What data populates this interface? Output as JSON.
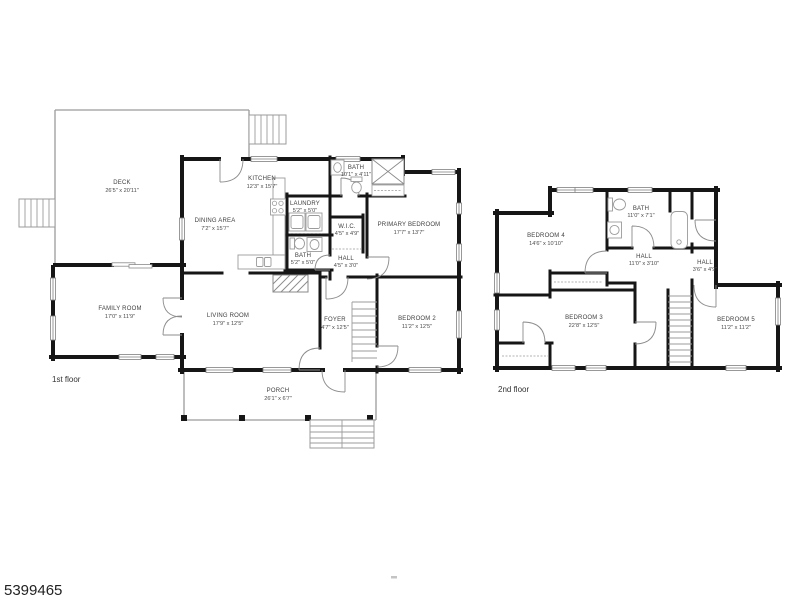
{
  "listing_id": "5399465",
  "floor1": {
    "label": "1st floor",
    "rooms": {
      "deck": {
        "name": "DECK",
        "dims": "26'5\" x 20'11\""
      },
      "kitchen": {
        "name": "KITCHEN",
        "dims": "12'3\" x 15'7\""
      },
      "bath_top": {
        "name": "BATH",
        "dims": "10'1\" x 4'11\""
      },
      "dining": {
        "name": "DINING AREA",
        "dims": "7'2\" x 15'7\""
      },
      "laundry": {
        "name": "LAUNDRY",
        "dims": "5'2\" x 5'0\""
      },
      "wic": {
        "name": "W.I.C.",
        "dims": "4'5\" x 4'9\""
      },
      "primary_bedroom": {
        "name": "PRIMARY BEDROOM",
        "dims": "17'7\" x 13'7\""
      },
      "bath_lower": {
        "name": "BATH",
        "dims": "5'2\" x 5'0\""
      },
      "hall": {
        "name": "HALL",
        "dims": "4'5\" x 3'0\""
      },
      "family_room": {
        "name": "FAMILY ROOM",
        "dims": "17'0\" x 11'9\""
      },
      "living_room": {
        "name": "LIVING ROOM",
        "dims": "17'9\" x 12'5\""
      },
      "foyer": {
        "name": "FOYER",
        "dims": "4'7\" x 12'5\""
      },
      "bedroom2": {
        "name": "BEDROOM 2",
        "dims": "11'2\" x 12'5\""
      },
      "porch": {
        "name": "PORCH",
        "dims": "26'1\" x 6'7\""
      }
    }
  },
  "floor2": {
    "label": "2nd floor",
    "rooms": {
      "bedroom4": {
        "name": "BEDROOM 4",
        "dims": "14'6\" x 10'10\""
      },
      "bath": {
        "name": "BATH",
        "dims": "11'0\" x 7'1\""
      },
      "hall": {
        "name": "HALL",
        "dims": "11'0\" x 3'10\""
      },
      "hall_small": {
        "name": "HALL",
        "dims": "3'6\" x 4'9\""
      },
      "bedroom3": {
        "name": "BEDROOM 3",
        "dims": "22'8\" x 12'5\""
      },
      "bedroom5": {
        "name": "BEDROOM 5",
        "dims": "11'2\" x 11'2\""
      }
    }
  },
  "colors": {
    "wall": "#161616",
    "minor_line": "#9b9b9b",
    "window_line": "#7f7f7f",
    "text": "#404040"
  }
}
